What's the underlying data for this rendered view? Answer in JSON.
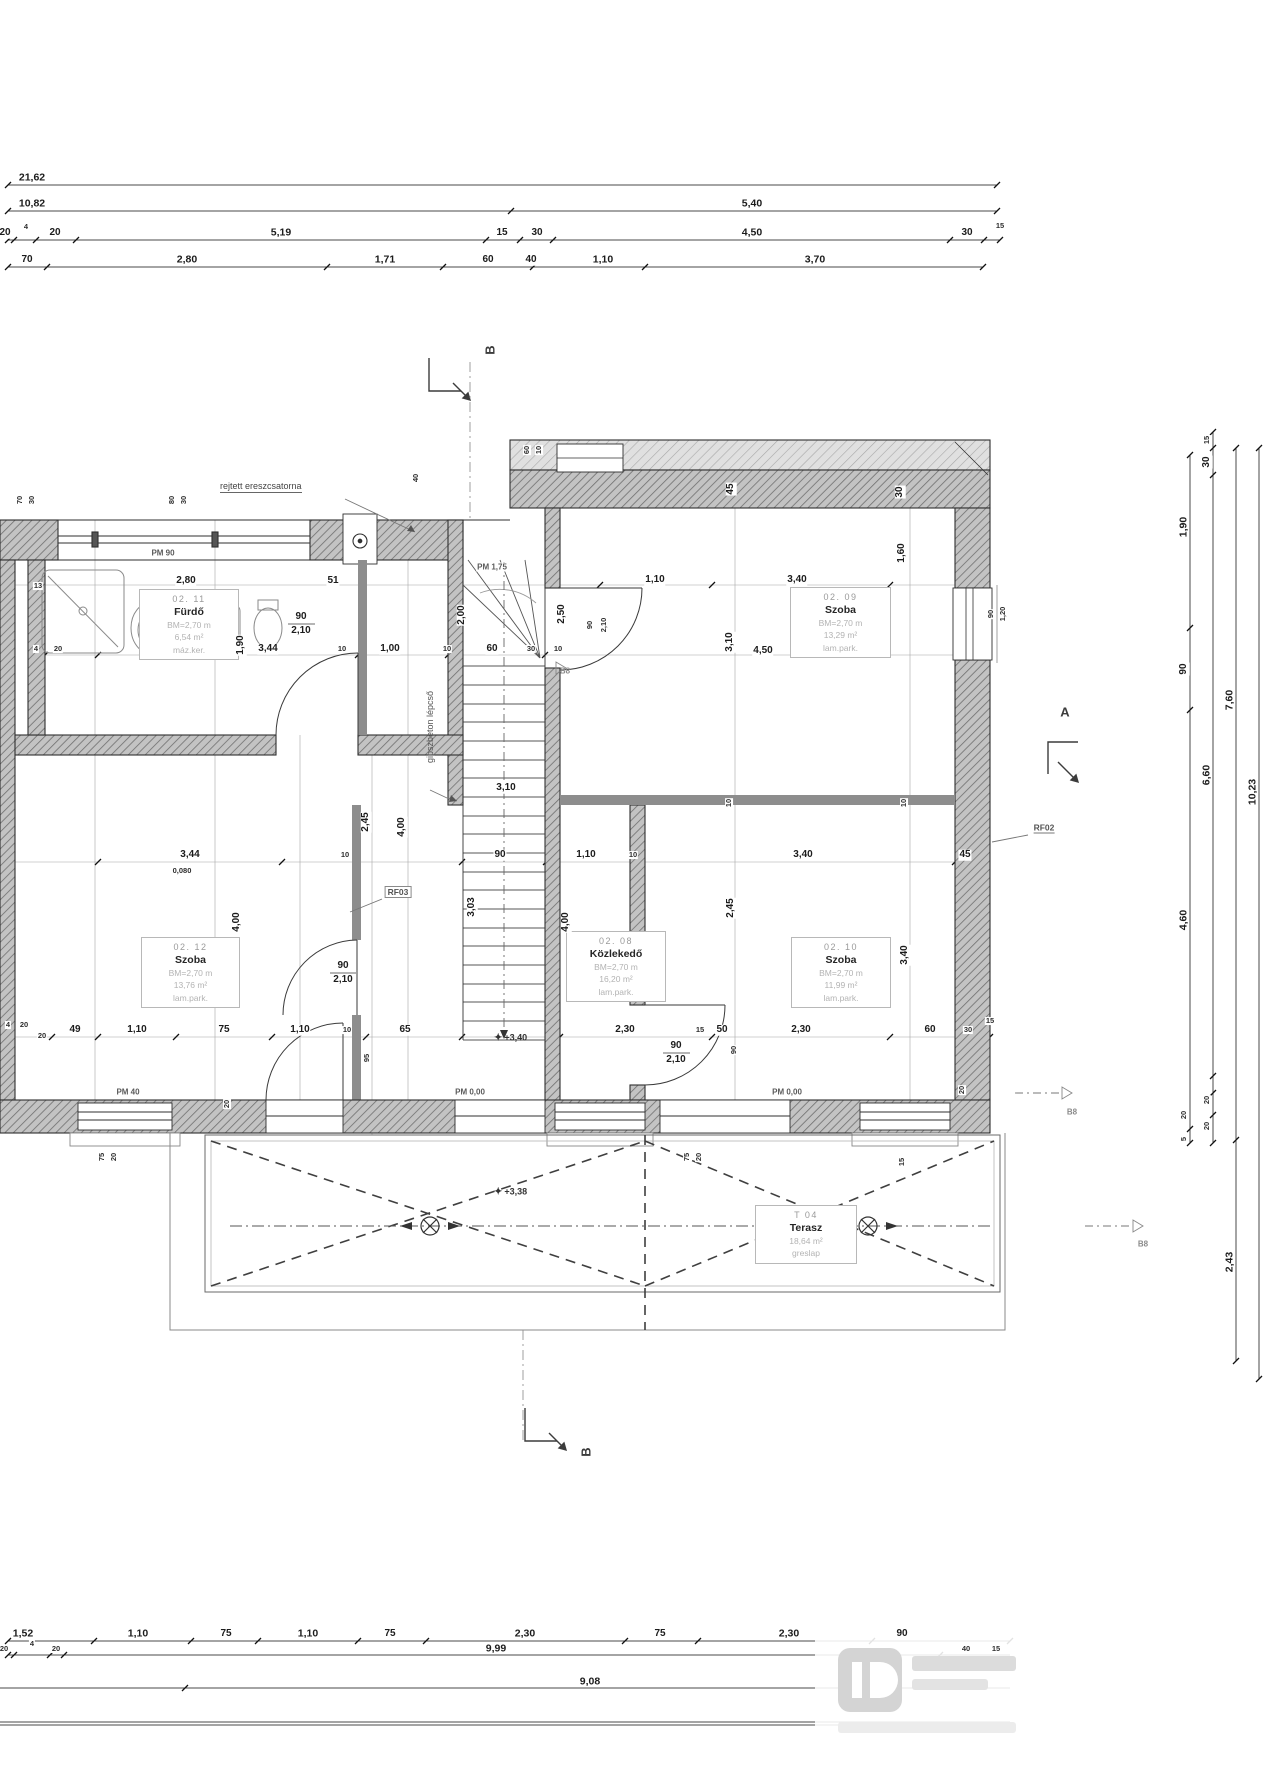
{
  "drawing": {
    "type": "floor-plan",
    "language": "hu",
    "colors": {
      "ink": "#1c1c1c",
      "wall_hatch": "#6f6f6f",
      "light_line": "#9e9e9e"
    }
  },
  "annotations": {
    "eaves_note": "rejtett ereszcsatorna",
    "stair_note": "gipszbeton lépcső",
    "pm_90": "PM 90",
    "pm_175": "PM 1,75",
    "pm_40": "PM 40",
    "pm_000": "PM 0,00",
    "rf02": "RF02",
    "rf03": "RF03",
    "b8": "B8",
    "level_hall": "+3,40",
    "level_terrace": "+3,38",
    "level_star": "✦"
  },
  "sections": {
    "a": "A",
    "b": "B"
  },
  "rooms": {
    "r0211": {
      "code": "02. 11",
      "name": "Fürdő",
      "height": "BM=2,70 m",
      "area": "6,54 m²",
      "floor": "máz.ker."
    },
    "r0209": {
      "code": "02. 09",
      "name": "Szoba",
      "height": "BM=2,70 m",
      "area": "13,29 m²",
      "floor": "lam.park."
    },
    "r0212": {
      "code": "02. 12",
      "name": "Szoba",
      "height": "BM=2,70 m",
      "area": "13,76 m²",
      "floor": "lam.park."
    },
    "r0208": {
      "code": "02. 08",
      "name": "Közlekedő",
      "height": "BM=2,70 m",
      "area": "16,20 m²",
      "floor": "lam.park."
    },
    "r0210": {
      "code": "02. 10",
      "name": "Szoba",
      "height": "BM=2,70 m",
      "area": "11,99 m²",
      "floor": "lam.park."
    },
    "t04": {
      "code": "T 04",
      "name": "Terasz",
      "area": "18,64 m²",
      "floor": "greslap"
    }
  },
  "labels": [
    [
      "21,62",
      32,
      178,
      0,
      "b"
    ],
    [
      "10,82",
      32,
      204,
      0,
      "b"
    ],
    [
      "5,40",
      752,
      204,
      0,
      "b"
    ],
    [
      "20",
      5,
      233,
      0,
      "n"
    ],
    [
      "4",
      26,
      227,
      0,
      "m"
    ],
    [
      "20",
      55,
      233,
      0,
      "n"
    ],
    [
      "5,19",
      281,
      233,
      0,
      "b"
    ],
    [
      "15",
      502,
      233,
      0,
      "n"
    ],
    [
      "30",
      537,
      233,
      0,
      "n"
    ],
    [
      "4,50",
      752,
      233,
      0,
      "b"
    ],
    [
      "30",
      967,
      233,
      0,
      "n"
    ],
    [
      "15",
      1000,
      226,
      0,
      "m"
    ],
    [
      "70",
      27,
      260,
      0,
      "n"
    ],
    [
      "2,80",
      187,
      260,
      0,
      "b"
    ],
    [
      "1,71",
      385,
      260,
      0,
      "b"
    ],
    [
      "60",
      488,
      260,
      0,
      "n"
    ],
    [
      "40",
      531,
      260,
      0,
      "n"
    ],
    [
      "1,10",
      603,
      260,
      0,
      "b"
    ],
    [
      "3,70",
      815,
      260,
      0,
      "b"
    ],
    [
      "1,52",
      23,
      1634,
      0,
      "b"
    ],
    [
      "1,10",
      138,
      1634,
      0,
      "b"
    ],
    [
      "75",
      226,
      1634,
      0,
      "n"
    ],
    [
      "1,10",
      308,
      1634,
      0,
      "b"
    ],
    [
      "75",
      390,
      1634,
      0,
      "n"
    ],
    [
      "2,30",
      525,
      1634,
      0,
      "b"
    ],
    [
      "75",
      660,
      1634,
      0,
      "n"
    ],
    [
      "2,30",
      789,
      1634,
      0,
      "b"
    ],
    [
      "90",
      902,
      1634,
      0,
      "n"
    ],
    [
      "20",
      4,
      1649,
      0,
      "m"
    ],
    [
      "4",
      32,
      1644,
      0,
      "m"
    ],
    [
      "20",
      56,
      1649,
      0,
      "m"
    ],
    [
      "9,99",
      496,
      1649,
      0,
      "b"
    ],
    [
      "40",
      966,
      1649,
      0,
      "m"
    ],
    [
      "15",
      996,
      1649,
      0,
      "m"
    ],
    [
      "9,08",
      590,
      1682,
      0,
      "b"
    ],
    [
      "1,90",
      1184,
      527,
      -90,
      "b"
    ],
    [
      "90",
      1184,
      669,
      -90,
      "n"
    ],
    [
      "4,60",
      1184,
      920,
      -90,
      "b"
    ],
    [
      "20",
      1184,
      1115,
      -90,
      "m"
    ],
    [
      "5",
      1184,
      1139,
      -90,
      "m"
    ],
    [
      "15",
      1207,
      440,
      -90,
      "m"
    ],
    [
      "30",
      1207,
      462,
      -90,
      "n"
    ],
    [
      "6,60",
      1207,
      775,
      -90,
      "b"
    ],
    [
      "20",
      1207,
      1100,
      -90,
      "m"
    ],
    [
      "20",
      1207,
      1126,
      -90,
      "m"
    ],
    [
      "7,60",
      1230,
      700,
      -90,
      "b"
    ],
    [
      "2,43",
      1230,
      1262,
      -90,
      "b"
    ],
    [
      "10,23",
      1253,
      792,
      -90,
      "b"
    ],
    [
      "13",
      38,
      586,
      0,
      "m"
    ],
    [
      "2,80",
      186,
      581,
      0,
      "n"
    ],
    [
      "51",
      333,
      581,
      0,
      "n"
    ],
    [
      "1,10",
      655,
      580,
      0,
      "n"
    ],
    [
      "3,40",
      797,
      580,
      0,
      "n"
    ],
    [
      "4",
      36,
      649,
      0,
      "m"
    ],
    [
      "20",
      58,
      649,
      0,
      "m"
    ],
    [
      "3,44",
      268,
      649,
      0,
      "n"
    ],
    [
      "10",
      342,
      649,
      0,
      "m"
    ],
    [
      "1,00",
      390,
      649,
      0,
      "n"
    ],
    [
      "10",
      447,
      649,
      0,
      "m"
    ],
    [
      "60",
      492,
      649,
      0,
      "n"
    ],
    [
      "30",
      531,
      649,
      0,
      "m"
    ],
    [
      "10",
      558,
      649,
      0,
      "m"
    ],
    [
      "4,50",
      763,
      651,
      0,
      "n"
    ],
    [
      "3,10",
      506,
      788,
      0,
      "n"
    ],
    [
      "3,44",
      190,
      855,
      0,
      "n"
    ],
    [
      "0,080",
      182,
      871,
      0,
      "m"
    ],
    [
      "10",
      345,
      855,
      0,
      "m"
    ],
    [
      "90",
      500,
      855,
      0,
      "n"
    ],
    [
      "1,10",
      586,
      855,
      0,
      "n"
    ],
    [
      "10",
      633,
      855,
      0,
      "m"
    ],
    [
      "3,40",
      803,
      855,
      0,
      "n"
    ],
    [
      "45",
      965,
      855,
      0,
      "n"
    ],
    [
      "4",
      8,
      1025,
      0,
      "m"
    ],
    [
      "20",
      24,
      1025,
      0,
      "m"
    ],
    [
      "20",
      42,
      1036,
      0,
      "m"
    ],
    [
      "49",
      75,
      1030,
      0,
      "n"
    ],
    [
      "1,10",
      137,
      1030,
      0,
      "n"
    ],
    [
      "75",
      224,
      1030,
      0,
      "n"
    ],
    [
      "1,10",
      300,
      1030,
      0,
      "n"
    ],
    [
      "10",
      347,
      1030,
      0,
      "m"
    ],
    [
      "65",
      405,
      1030,
      0,
      "n"
    ],
    [
      "2,30",
      625,
      1030,
      0,
      "n"
    ],
    [
      "15",
      700,
      1030,
      0,
      "m"
    ],
    [
      "50",
      722,
      1030,
      0,
      "n"
    ],
    [
      "2,30",
      801,
      1030,
      0,
      "n"
    ],
    [
      "60",
      930,
      1030,
      0,
      "n"
    ],
    [
      "30",
      968,
      1030,
      0,
      "m"
    ],
    [
      "15",
      990,
      1021,
      0,
      "m"
    ],
    [
      "70",
      20,
      500,
      -90,
      "m"
    ],
    [
      "30",
      32,
      500,
      -90,
      "m"
    ],
    [
      "80",
      172,
      500,
      -90,
      "m"
    ],
    [
      "30",
      184,
      500,
      -90,
      "m"
    ],
    [
      "40",
      416,
      478,
      -90,
      "m"
    ],
    [
      "60",
      527,
      450,
      -90,
      "m"
    ],
    [
      "10",
      539,
      450,
      -90,
      "m"
    ],
    [
      "45",
      731,
      489,
      -90,
      "n"
    ],
    [
      "30",
      900,
      492,
      -90,
      "n"
    ],
    [
      "1,60",
      902,
      553,
      -90,
      "n"
    ],
    [
      "2,00",
      462,
      615,
      -90,
      "n"
    ],
    [
      "2,50",
      562,
      614,
      -90,
      "n"
    ],
    [
      "3,10",
      730,
      642,
      -90,
      "n"
    ],
    [
      "90",
      590,
      625,
      -90,
      "m"
    ],
    [
      "2,10",
      604,
      625,
      -90,
      "m"
    ],
    [
      "1,90",
      241,
      645,
      -90,
      "n"
    ],
    [
      "2,45",
      366,
      822,
      -90,
      "n"
    ],
    [
      "4,00",
      402,
      827,
      -90,
      "n"
    ],
    [
      "3,03",
      472,
      907,
      -90,
      "n"
    ],
    [
      "4,00",
      237,
      922,
      -90,
      "n"
    ],
    [
      "4,00",
      566,
      922,
      -90,
      "n"
    ],
    [
      "2,45",
      731,
      908,
      -90,
      "n"
    ],
    [
      "3,40",
      905,
      955,
      -90,
      "n"
    ],
    [
      "10",
      729,
      803,
      -90,
      "m"
    ],
    [
      "10",
      904,
      803,
      -90,
      "m"
    ],
    [
      "95",
      367,
      1058,
      -90,
      "m"
    ],
    [
      "20",
      227,
      1104,
      -90,
      "m"
    ],
    [
      "20",
      962,
      1090,
      -90,
      "m"
    ],
    [
      "90",
      734,
      1050,
      -90,
      "m"
    ],
    [
      "90",
      991,
      614,
      -90,
      "m"
    ],
    [
      "1,20",
      1003,
      614,
      -90,
      "m"
    ],
    [
      "75",
      102,
      1157,
      -90,
      "m"
    ],
    [
      "20",
      114,
      1157,
      -90,
      "m"
    ],
    [
      "75",
      687,
      1157,
      -90,
      "m"
    ],
    [
      "20",
      699,
      1157,
      -90,
      "m"
    ],
    [
      "15",
      902,
      1162,
      -90,
      "m"
    ],
    [
      "90",
      301,
      617,
      0,
      "n"
    ],
    [
      "2,10",
      301,
      631,
      0,
      "n"
    ],
    [
      "90",
      343,
      966,
      0,
      "n"
    ],
    [
      "2,10",
      343,
      980,
      0,
      "n"
    ],
    [
      "90",
      676,
      1046,
      0,
      "n"
    ],
    [
      "2,10",
      676,
      1060,
      0,
      "n"
    ]
  ]
}
